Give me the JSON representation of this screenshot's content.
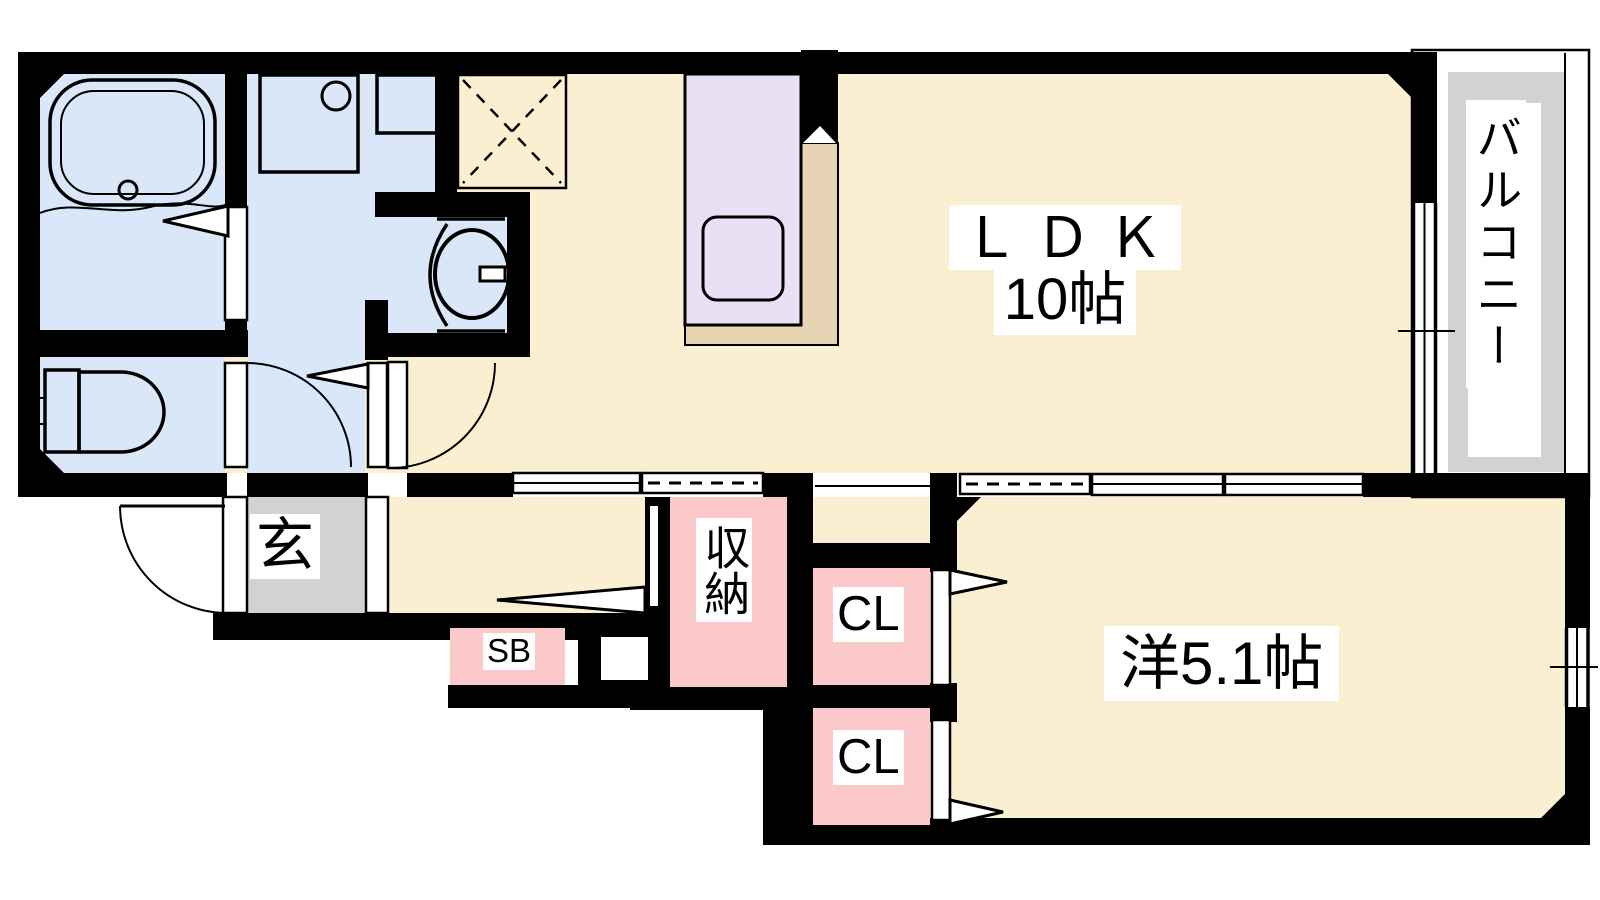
{
  "plan": {
    "title": "1LDK apartment floor plan",
    "rooms": {
      "ldk": {
        "label_line1": "ＬＤＫ",
        "label_line2": "10帖"
      },
      "western_room": {
        "label": "洋5.1帖"
      },
      "balcony": {
        "label": "バルコニー"
      },
      "entrance": {
        "label": "玄"
      },
      "shoe_box": {
        "label": "SB"
      },
      "storage": {
        "label": "収納"
      },
      "closet_upper": {
        "label": "CL"
      },
      "closet_lower": {
        "label": "CL"
      }
    },
    "colors": {
      "floor_cream": "#FAF0D1",
      "wet_blue": "#D9E7F8",
      "kitchen_purple": "#E8E0F4",
      "counter_tan": "#E6D4B5",
      "storage_pink": "#FBC9C9",
      "balcony_gray": "#D2D2D2",
      "wall_black": "#000000"
    },
    "fixtures": [
      "bathtub",
      "toilet",
      "washbasin",
      "washing-machine-pan",
      "kitchen-counter",
      "kitchen-sink",
      "refrigerator-space",
      "sliding-windows",
      "hinged-doors",
      "folding-doors"
    ]
  }
}
